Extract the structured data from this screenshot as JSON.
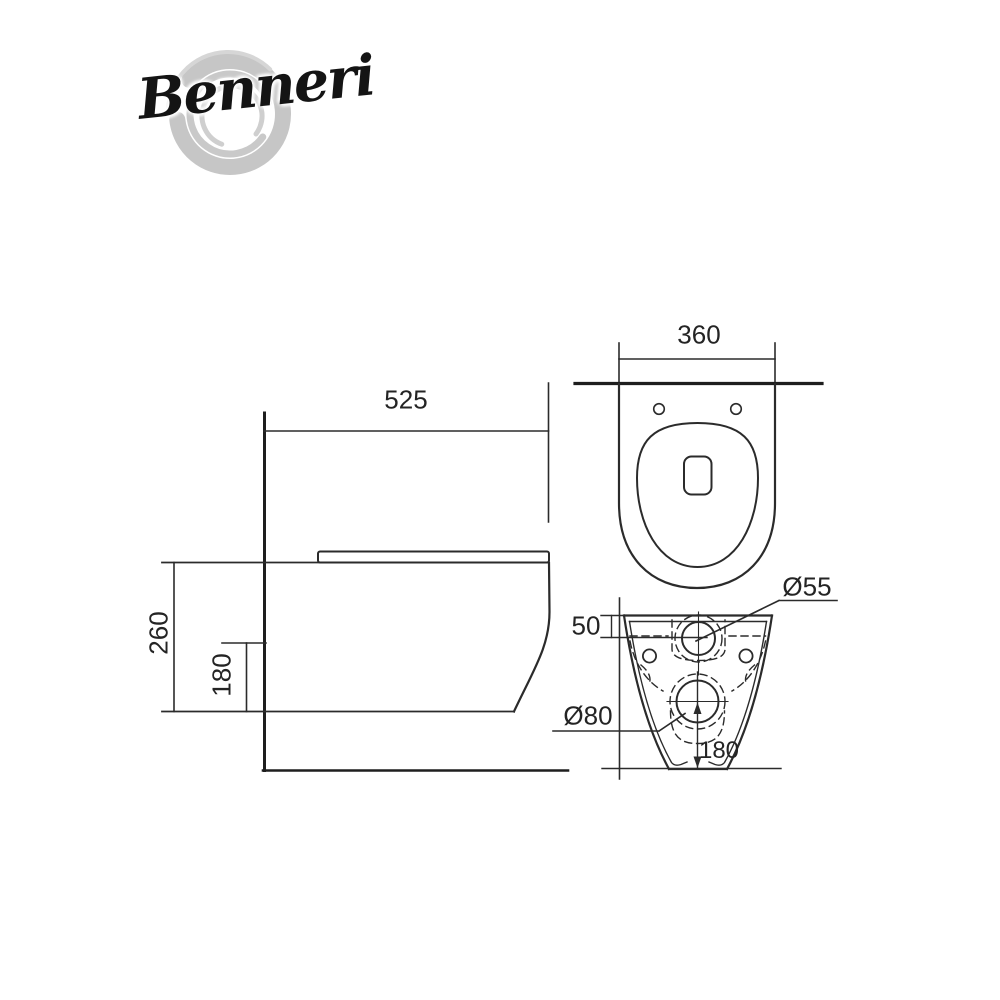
{
  "logo": {
    "brand": "Benneri",
    "ring_color": "#c6c6c6",
    "text_color": "#141414"
  },
  "drawing": {
    "subject": "wall-hung-toilet-technical-drawing",
    "views": [
      "side-view",
      "top-view",
      "rear-view"
    ],
    "line_color": "#2b2b2b",
    "wall_line_color": "#1e1e1e",
    "background": "#ffffff"
  },
  "dims": {
    "side_width": "525",
    "side_height": "260",
    "side_rim": "180",
    "top_width": "360",
    "inlet_offset": "50",
    "inlet_dia": "Ø55",
    "outlet_dia": "Ø80",
    "outlet_height": "180"
  }
}
